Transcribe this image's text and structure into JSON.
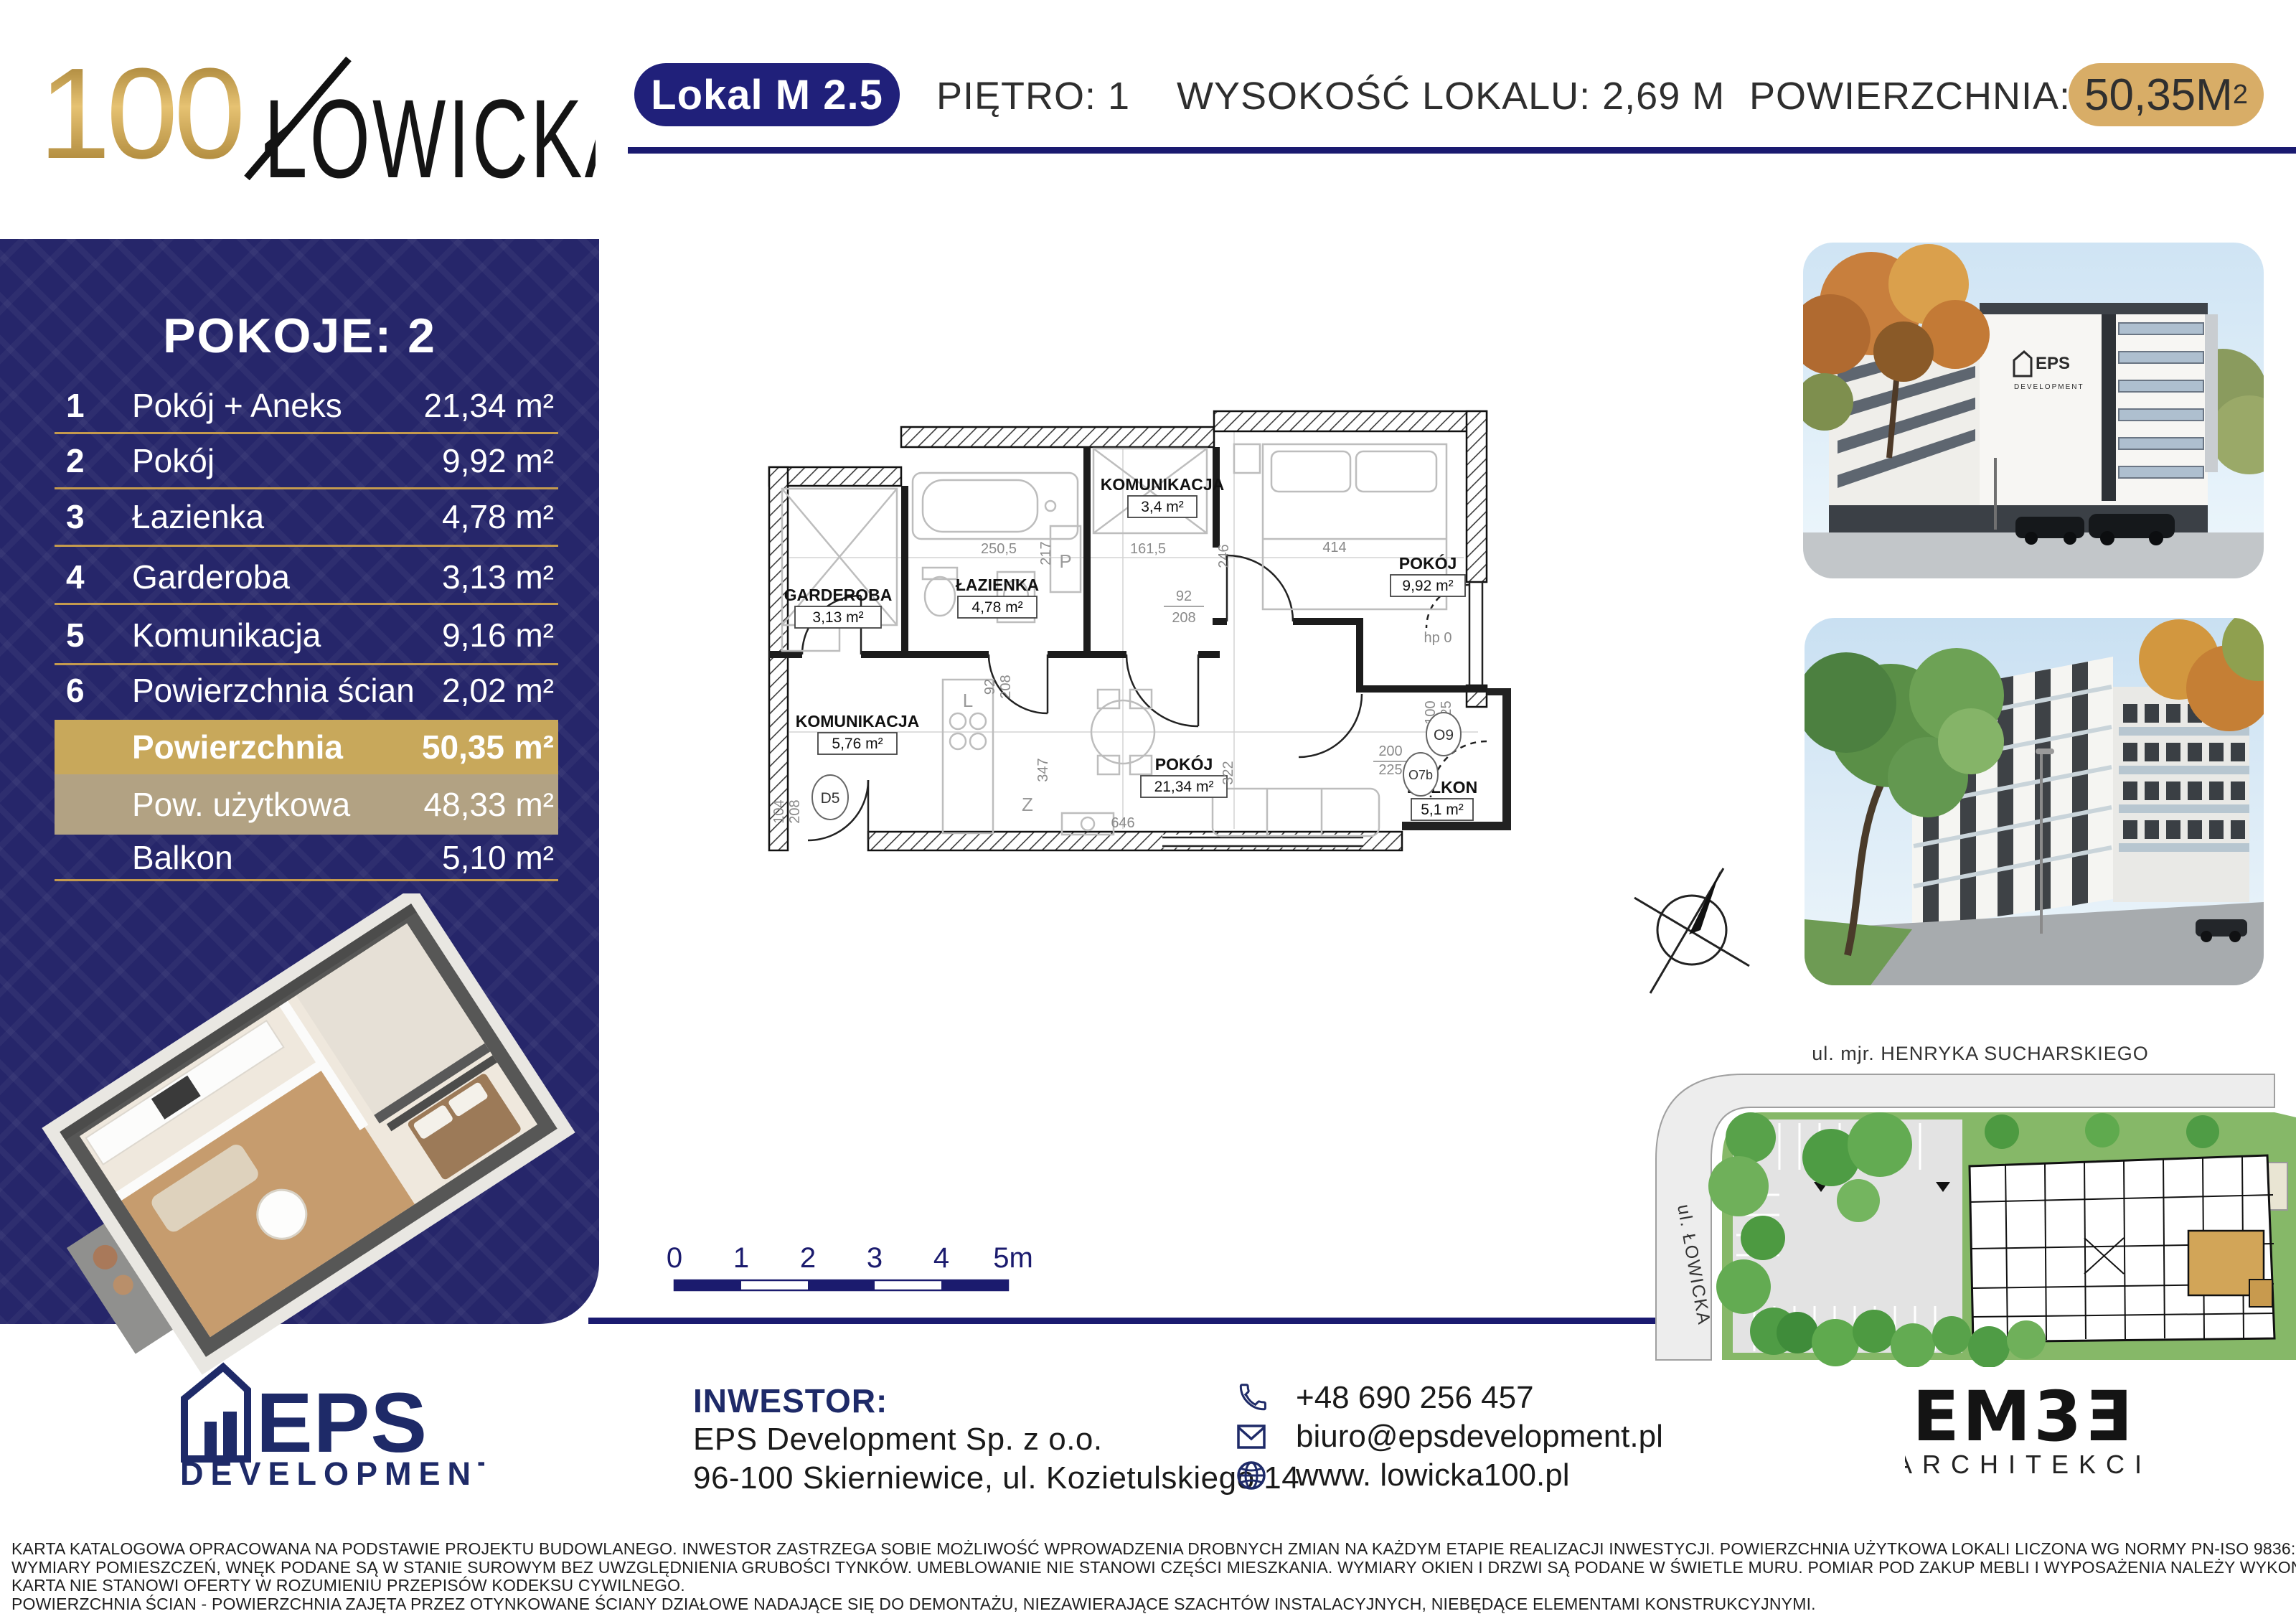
{
  "colors": {
    "navy": "#20207a",
    "gold_pill": "#d8ad67",
    "gold_bar": "#c8a85b",
    "tan_bar": "#b2a283",
    "sidebar_bg": "#26266a",
    "site_green": "#86b868"
  },
  "header": {
    "brand_num": "100",
    "brand_name": "ŁOWICKA",
    "unit_badge": "Lokal M 2.5",
    "floor": "PIĘTRO: 1",
    "height": "WYSOKOŚĆ LOKALU: 2,69 M",
    "area_label": "POWIERZCHNIA:",
    "area_value": "50,35M",
    "area_sup": "2"
  },
  "sidebar": {
    "title": "POKOJE: 2",
    "rooms": [
      {
        "num": "1",
        "label": "Pokój + Aneks",
        "area": "21,34 m²"
      },
      {
        "num": "2",
        "label": "Pokój",
        "area": "9,92 m²"
      },
      {
        "num": "3",
        "label": "Łazienka",
        "area": "4,78 m²"
      },
      {
        "num": "4",
        "label": "Garderoba",
        "area": "3,13 m²"
      },
      {
        "num": "5",
        "label": "Komunikacja",
        "area": "9,16 m²"
      },
      {
        "num": "6",
        "label": "Powierzchnia ścian",
        "area": "2,02 m²"
      }
    ],
    "summary": [
      {
        "label": "Powierzchnia",
        "area": "50,35 m²"
      },
      {
        "label": "Pow. użytkowa",
        "area": "48,33 m²"
      },
      {
        "label": "Balkon",
        "area": "5,10 m²"
      }
    ]
  },
  "plan": {
    "rooms": [
      {
        "name": "GARDEROBA",
        "area": "3,13 m²"
      },
      {
        "name": "ŁAZIENKA",
        "area": "4,78 m²"
      },
      {
        "name": "KOMUNIKACJA",
        "area": "3,4 m²"
      },
      {
        "name": "POKÓJ",
        "area": "9,92 m²"
      },
      {
        "name": "KOMUNIKACJA",
        "area": "5,76 m²"
      },
      {
        "name": "POKÓJ",
        "area": "21,34 m²"
      },
      {
        "name": "BALKON",
        "area": "5,1 m²"
      }
    ],
    "dims": {
      "top1": "250,5",
      "top2": "217",
      "top3": "161,5",
      "top4": "246",
      "top5": "414",
      "door1_w": "92",
      "door1_h": "208",
      "door2_w": "92",
      "door2_h": "208",
      "v1": "347",
      "v2": "322",
      "h1": "646",
      "hp": "hp 0",
      "win1_w": "100",
      "win1_h": "225",
      "win2_w": "200",
      "win2_h": "225",
      "ent_w": "104",
      "ent_h": "208"
    },
    "markers": {
      "d5": "D5",
      "o9": "O9",
      "o7b": "O7b",
      "p": "P",
      "l": "L",
      "z": "Z"
    }
  },
  "scalebar": {
    "labels": [
      "0",
      "1",
      "2",
      "3",
      "4",
      "5m"
    ]
  },
  "site": {
    "street_top": "ul. mjr. HENRYKA SUCHARSKIEGO",
    "street_left": "ul. ŁOWICKA"
  },
  "footer": {
    "eps_name": "EPS",
    "eps_sub": "DEVELOPMENT",
    "investor_label": "INWESTOR:",
    "investor_name": "EPS Development Sp. z o.o.",
    "investor_address": "96-100 Skierniewice, ul. Kozietulskiego 14",
    "phone": "+48 690 256 457",
    "email": "biuro@epsdevelopment.pl",
    "website": "www. lowicka100.pl",
    "embe_name": "EM3Ǝ",
    "embe_sub": "ARCHITEKCI"
  },
  "disclaimer": {
    "line1": "KARTA KATALOGOWA OPRACOWANA NA PODSTAWIE PROJEKTU BUDOWLANEGO. INWESTOR ZASTRZEGA SOBIE MOŻLIWOŚĆ WPROWADZENIA DROBNYCH ZMIAN NA KAŻDYM ETAPIE REALIZACJI INWESTYCJI. POWIERZCHNIA UŻYTKOWA LOKALI LICZONA WG NORMY PN-ISO 9836:2022-07.",
    "line2": "WYMIARY POMIESZCZEŃ, WNĘK PODANE SĄ W STANIE SUROWYM BEZ UWZGLĘDNIENIA GRUBOŚCI TYNKÓW. UMEBLOWANIE NIE STANOWI CZĘŚCI MIESZKANIA. WYMIARY OKIEN I DRZWI SĄ PODANE W ŚWIETLE MURU. POMIAR POD ZAKUP MEBLI I WYPOSAŻENIA NALEŻY WYKONAĆ Z NATURY.",
    "line3": "KARTA NIE STANOWI OFERTY W ROZUMIENIU PRZEPISÓW KODEKSU CYWILNEGO.",
    "line4": "POWIERZCHNIA ŚCIAN - POWIERZCHNIA ZAJĘTA PRZEZ OTYNKOWANE ŚCIANY DZIAŁOWE NADAJĄCE SIĘ DO DEMONTAŻU, NIEZAWIERAJĄCE SZACHTÓW INSTALACYJNYCH, NIEBĘDĄCE ELEMENTAMI KONSTRUKCYJNYMI."
  }
}
